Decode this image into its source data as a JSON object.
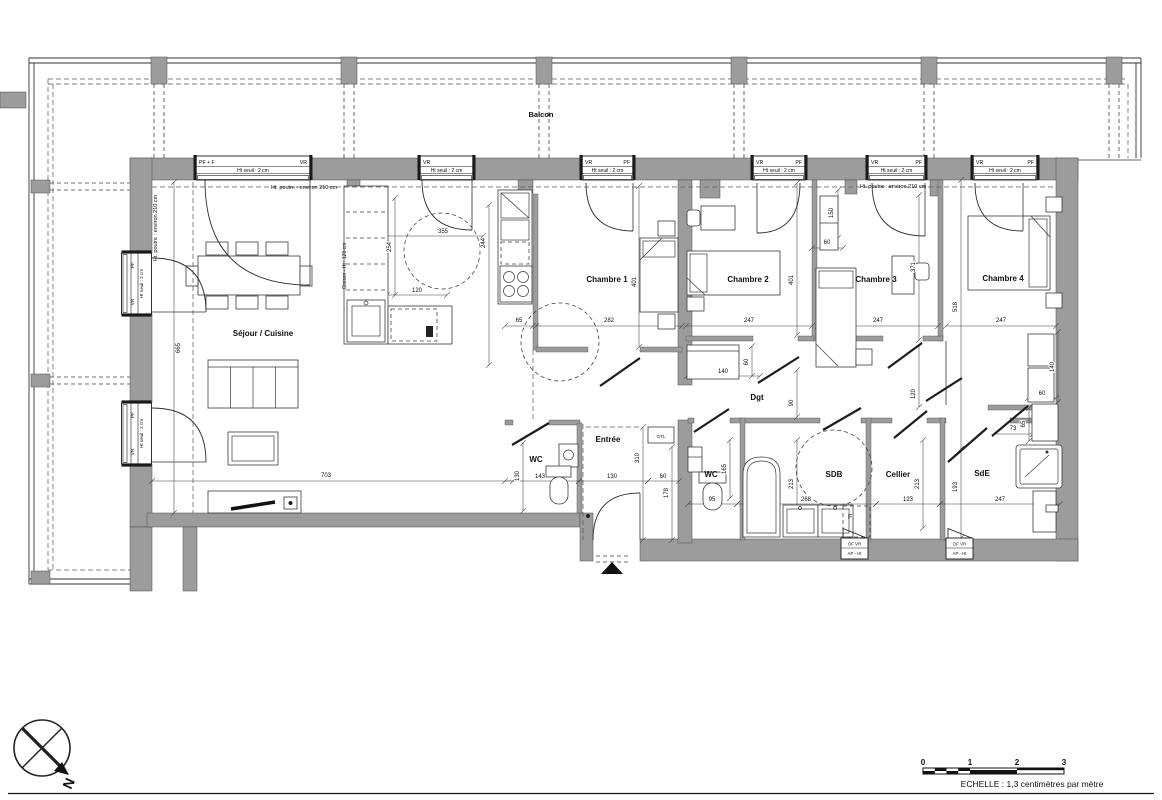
{
  "plan": {
    "room_labels": [
      {
        "name": "balcon",
        "text": "Balcon",
        "x": 541,
        "y": 117,
        "size": 7.5
      },
      {
        "name": "sejour-cuisine",
        "text": "Séjour / Cuisine",
        "x": 263,
        "y": 336,
        "size": 8
      },
      {
        "name": "chambre-1",
        "text": "Chambre 1",
        "x": 607,
        "y": 282,
        "size": 8
      },
      {
        "name": "chambre-2",
        "text": "Chambre 2",
        "x": 748,
        "y": 282,
        "size": 8
      },
      {
        "name": "chambre-3",
        "text": "Chambre 3",
        "x": 876,
        "y": 282,
        "size": 8
      },
      {
        "name": "chambre-4",
        "text": "Chambre 4",
        "x": 1003,
        "y": 281,
        "size": 8
      },
      {
        "name": "wc-1",
        "text": "WC",
        "x": 536,
        "y": 462,
        "size": 8
      },
      {
        "name": "entree",
        "text": "Entrée",
        "x": 608,
        "y": 442,
        "size": 8
      },
      {
        "name": "dgt",
        "text": "Dgt",
        "x": 757,
        "y": 400,
        "size": 8
      },
      {
        "name": "wc-2",
        "text": "WC",
        "x": 711,
        "y": 477,
        "size": 8
      },
      {
        "name": "sdb",
        "text": "SDB",
        "x": 834,
        "y": 477,
        "size": 8
      },
      {
        "name": "cellier",
        "text": "Cellier",
        "x": 898,
        "y": 477,
        "size": 8
      },
      {
        "name": "sde",
        "text": "SdE",
        "x": 982,
        "y": 476,
        "size": 8
      }
    ],
    "annotations": [
      {
        "name": "poutre-1",
        "text": "Ht. poutre : environ 210 cm",
        "x": 304,
        "y": 189,
        "size": 5.5
      },
      {
        "name": "poutre-2",
        "text": "Ht. poutre : environ 210 cm",
        "x": 893,
        "y": 188,
        "size": 5.5
      },
      {
        "name": "poutre-3",
        "text": "Ht. poutre : environ 210 cm",
        "x": 157,
        "y": 228,
        "rot": true,
        "size": 5.5
      },
      {
        "name": "cloison",
        "text": "Cloison - Ht : 120 cm",
        "x": 346,
        "y": 266,
        "rot": true,
        "size": 5
      },
      {
        "name": "gtl",
        "text": "GTL",
        "x": 661,
        "y": 438,
        "size": 4.5,
        "color": "#8a8a8a"
      },
      {
        "name": "f-box",
        "text": "F",
        "x": 850,
        "y": 519,
        "size": 7,
        "color": "#9a9a9a"
      }
    ],
    "dimensions": [
      {
        "v": "355",
        "x": 443,
        "y": 233
      },
      {
        "v": "254",
        "x": 391,
        "y": 247,
        "rot": true
      },
      {
        "v": "244",
        "x": 485,
        "y": 243,
        "rot": true
      },
      {
        "v": "120",
        "x": 417,
        "y": 292
      },
      {
        "v": "65",
        "x": 519,
        "y": 322
      },
      {
        "v": "282",
        "x": 609,
        "y": 322
      },
      {
        "v": "401",
        "x": 636,
        "y": 282,
        "rot": true
      },
      {
        "v": "401",
        "x": 793,
        "y": 280,
        "rot": true
      },
      {
        "v": "150",
        "x": 833,
        "y": 213,
        "rot": true
      },
      {
        "v": "60",
        "x": 827,
        "y": 244
      },
      {
        "v": "371",
        "x": 915,
        "y": 267,
        "rot": true
      },
      {
        "v": "247",
        "x": 749,
        "y": 322
      },
      {
        "v": "247",
        "x": 878,
        "y": 322
      },
      {
        "v": "247",
        "x": 1001,
        "y": 322
      },
      {
        "v": "518",
        "x": 957,
        "y": 307,
        "rot": true
      },
      {
        "v": "140",
        "x": 723,
        "y": 373
      },
      {
        "v": "60",
        "x": 748,
        "y": 362,
        "rot": true
      },
      {
        "v": "90",
        "x": 793,
        "y": 403,
        "rot": true
      },
      {
        "v": "120",
        "x": 915,
        "y": 394,
        "rot": true
      },
      {
        "v": "140",
        "x": 1054,
        "y": 367,
        "rot": true
      },
      {
        "v": "60",
        "x": 1042,
        "y": 395
      },
      {
        "v": "73",
        "x": 1013,
        "y": 430
      },
      {
        "v": "65",
        "x": 1025,
        "y": 424,
        "rot": true
      },
      {
        "v": "130",
        "x": 519,
        "y": 476,
        "rot": true
      },
      {
        "v": "143",
        "x": 540,
        "y": 478
      },
      {
        "v": "130",
        "x": 612,
        "y": 478
      },
      {
        "v": "60",
        "x": 663,
        "y": 478
      },
      {
        "v": "310",
        "x": 639,
        "y": 458,
        "rot": true
      },
      {
        "v": "178",
        "x": 668,
        "y": 493,
        "rot": true
      },
      {
        "v": "165",
        "x": 726,
        "y": 469,
        "rot": true
      },
      {
        "v": "95",
        "x": 712,
        "y": 501
      },
      {
        "v": "268",
        "x": 806,
        "y": 501
      },
      {
        "v": "123",
        "x": 908,
        "y": 501
      },
      {
        "v": "247",
        "x": 1000,
        "y": 501
      },
      {
        "v": "213",
        "x": 793,
        "y": 484,
        "rot": true
      },
      {
        "v": "213",
        "x": 919,
        "y": 484,
        "rot": true
      },
      {
        "v": "193",
        "x": 957,
        "y": 487,
        "rot": true
      },
      {
        "v": "703",
        "x": 326,
        "y": 477
      },
      {
        "v": "665",
        "x": 180,
        "y": 348,
        "rot": true
      }
    ],
    "openings": {
      "top_windows": [
        {
          "left": "PF + F",
          "right": "VR",
          "sub": "Ht seuil : 2 cm",
          "x": 196,
          "w": 114
        },
        {
          "left": "VR",
          "right": "",
          "sub": "Ht seuil : 2 cm",
          "x": 420,
          "w": 53
        },
        {
          "left": "VR",
          "right": "PF",
          "sub": "Ht seuil : 2 cm",
          "x": 582,
          "w": 51
        },
        {
          "left": "VR",
          "right": "PF",
          "sub": "Ht seuil : 2 cm",
          "x": 753,
          "w": 52
        },
        {
          "left": "VR",
          "right": "PF",
          "sub": "Ht seuil : 2 cm",
          "x": 868,
          "w": 57
        },
        {
          "left": "VR",
          "right": "PF",
          "sub": "Ht seuil : 2 cm",
          "x": 973,
          "w": 64
        }
      ],
      "left_windows": [
        {
          "side1": "PF",
          "sub": "Ht seuil : 2 cm",
          "side2": "VR",
          "y": 253,
          "h": 61
        },
        {
          "side1": "PF",
          "sub": "Ht seuil : 2 cm",
          "side2": "VR",
          "y": 403,
          "h": 61
        }
      ],
      "bottom_windows": [
        {
          "line1": "OF  VR",
          "line2": "AP - Ht",
          "x": 841
        },
        {
          "line1": "OF  VR",
          "line2": "AP - Ht",
          "x": 946
        }
      ]
    },
    "compass": {
      "label": "N"
    },
    "scale_bar": {
      "ticks": [
        "0",
        "1",
        "2",
        "3"
      ],
      "caption": "ECHELLE : 1,3 centimètres par mètre"
    }
  }
}
